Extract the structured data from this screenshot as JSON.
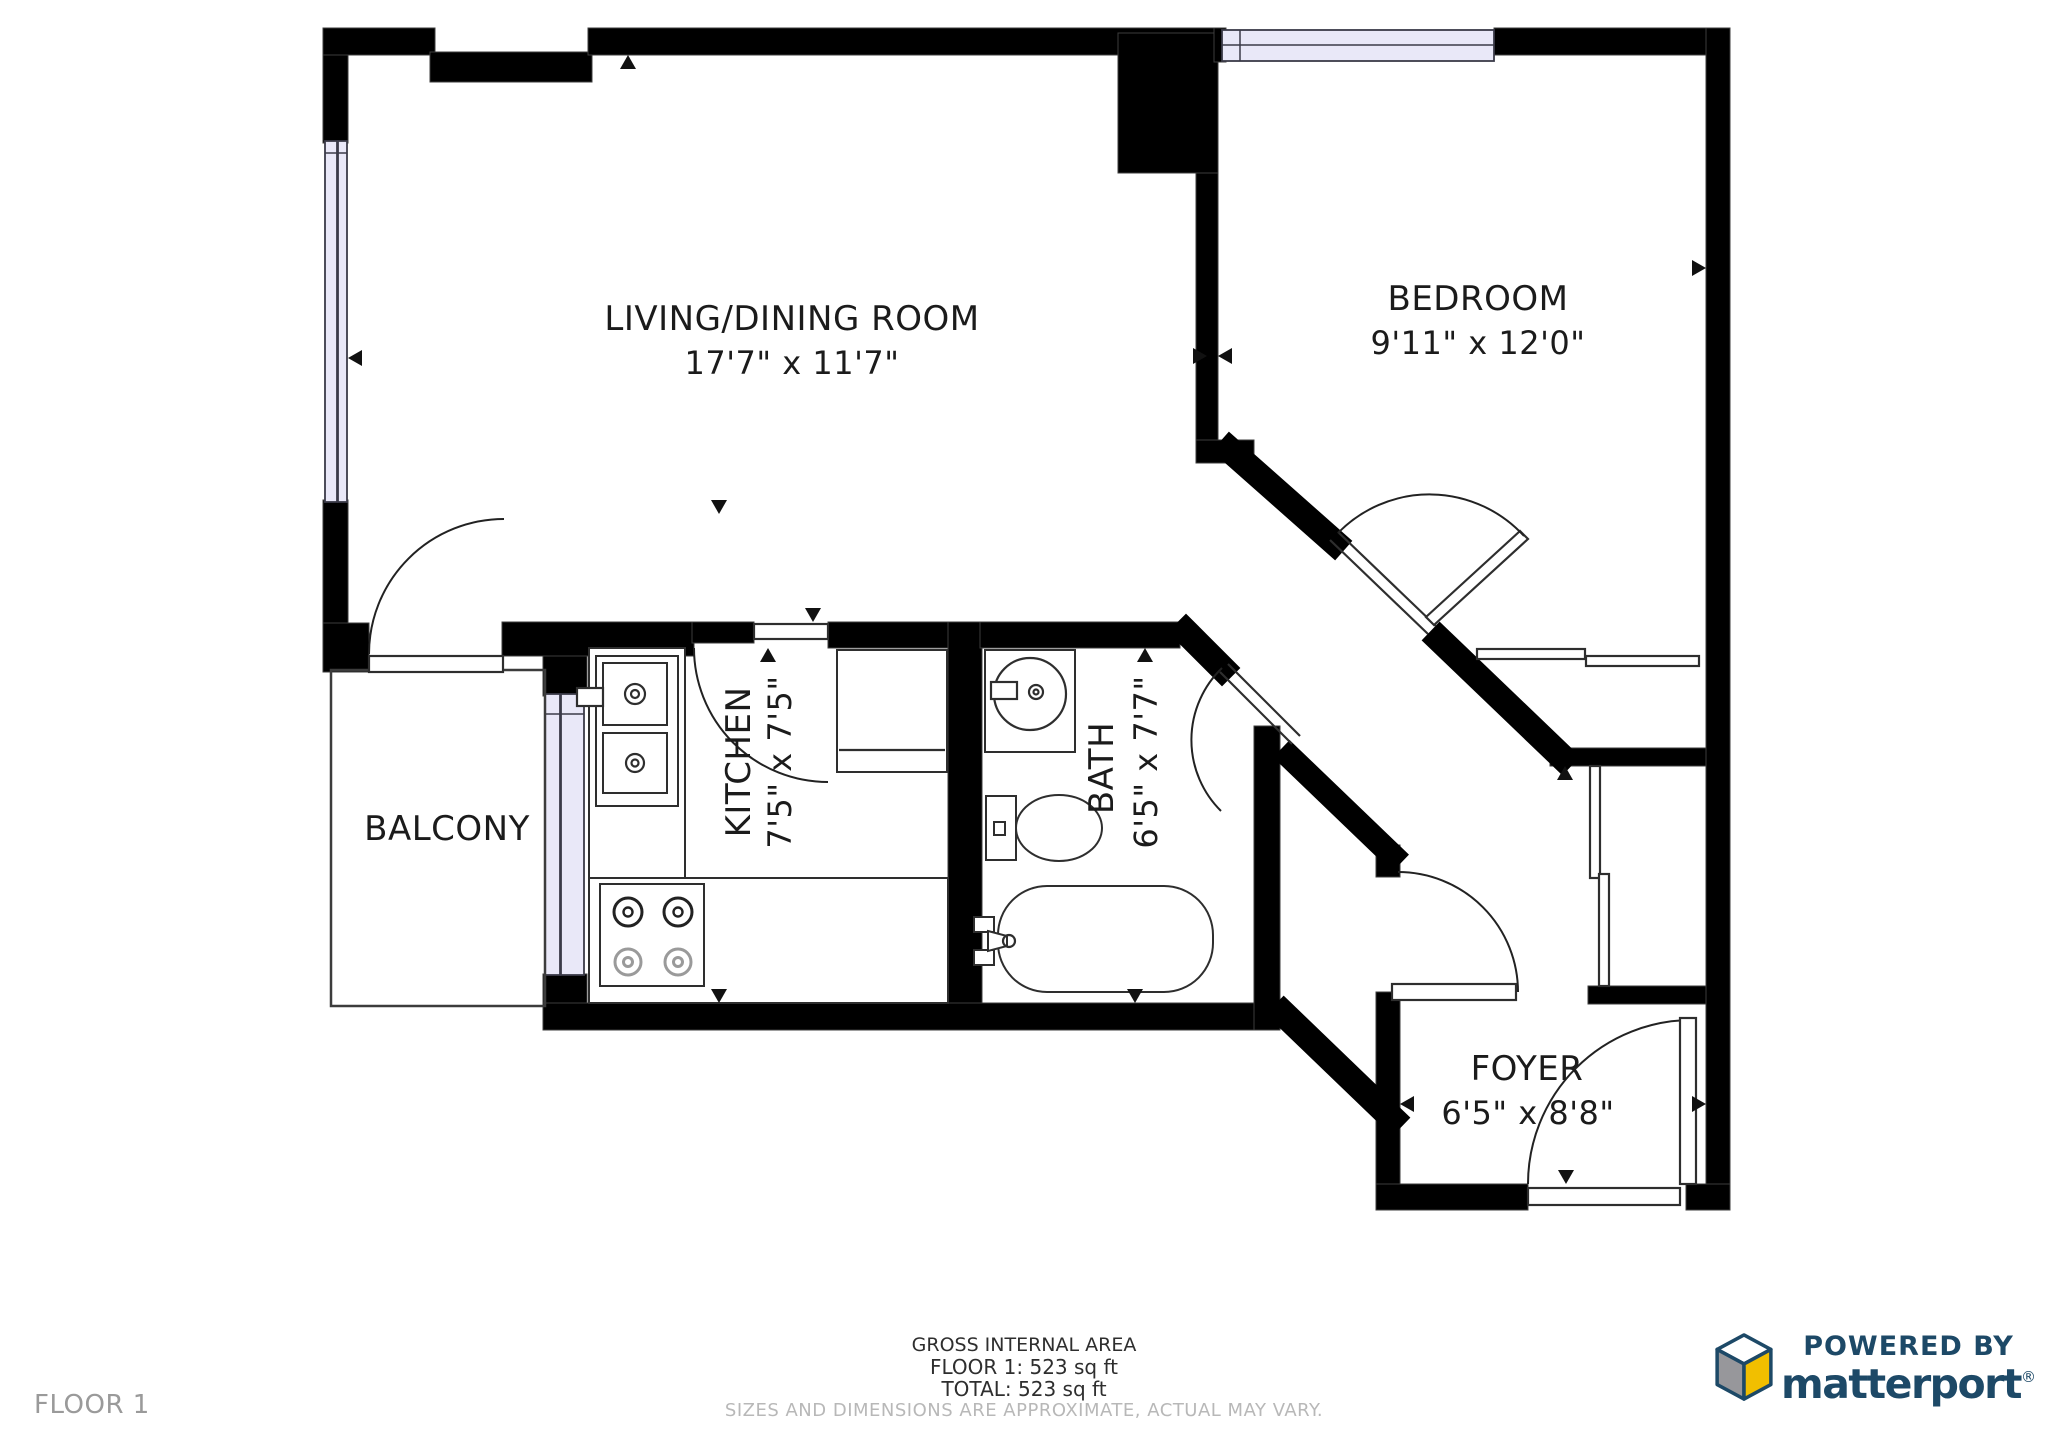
{
  "plan": {
    "rooms": {
      "living": {
        "name": "LIVING/DINING ROOM",
        "dims": "17'7\" x 11'7\""
      },
      "bedroom": {
        "name": "BEDROOM",
        "dims": "9'11\" x 12'0\""
      },
      "kitchen": {
        "name": "KITCHEN",
        "dims": "7'5\" x 7'5\""
      },
      "bath": {
        "name": "BATH",
        "dims": "6'5\" x 7'7\""
      },
      "balcony": {
        "name": "BALCONY",
        "dims": ""
      },
      "foyer": {
        "name": "FOYER",
        "dims": "6'5\" x 8'8\""
      }
    }
  },
  "footer": {
    "floor_label": "FLOOR 1",
    "gross_area_title": "GROSS INTERNAL AREA",
    "floor_area": "FLOOR 1: 523 sq ft",
    "total_area": "TOTAL: 523 sq ft",
    "disclaimer": "SIZES AND DIMENSIONS ARE APPROXIMATE, ACTUAL MAY VARY."
  },
  "branding": {
    "powered_by": "POWERED BY",
    "brand_name": "matterport",
    "registered_mark": "®"
  },
  "colors": {
    "wall": "#000000",
    "window_fill": "#e9e8f8",
    "brand": "#1d4967",
    "cube_yellow": "#f1bf00",
    "cube_gray": "#97979b",
    "muted_text": "#9a9a9a",
    "disclaimer_text": "#b8b8b8"
  }
}
